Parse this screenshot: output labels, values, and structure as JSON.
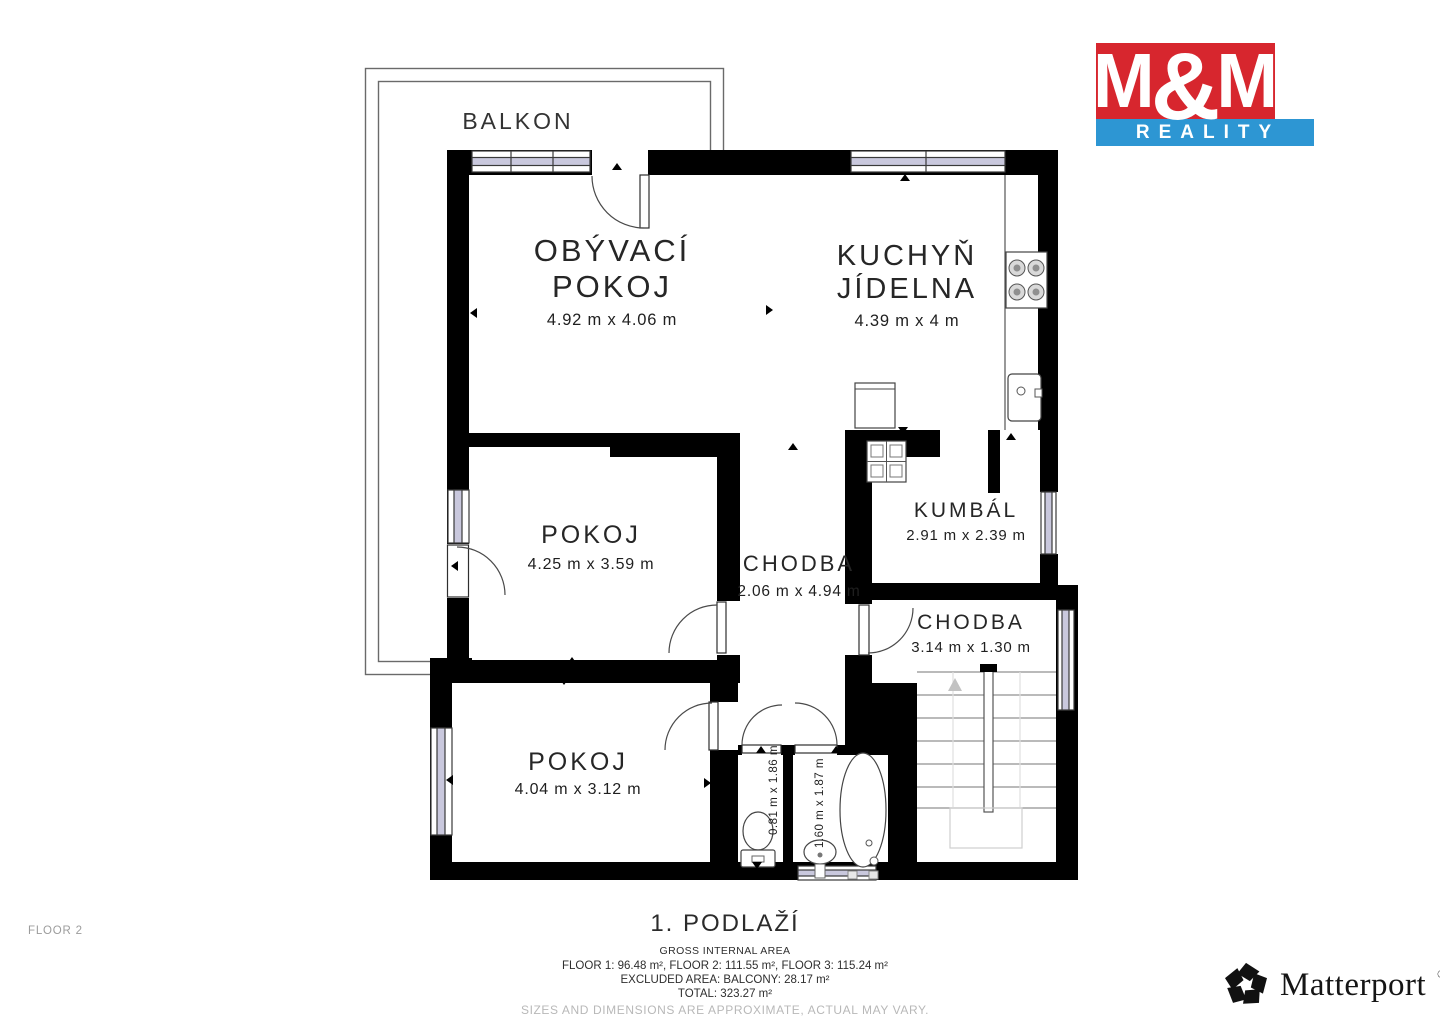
{
  "brand": {
    "m_left": "M",
    "ampersand": "&",
    "m_right": "M",
    "tagline": "REALITY",
    "red": "#d7262e",
    "blue": "#2d96d3"
  },
  "plan": {
    "balkon_label": "BALKON",
    "floor_title": "1. PODLAŽÍ",
    "rooms": {
      "obyvaci": {
        "line1": "OBÝVACÍ",
        "line2": "POKOJ",
        "dims": "4.92 m x 4.06 m"
      },
      "kuchyn": {
        "line1": "KUCHYŇ",
        "line2": "JÍDELNA",
        "dims": "4.39 m x 4 m"
      },
      "pokoj_stred": {
        "line1": "POKOJ",
        "dims": "4.25 m x 3.59 m"
      },
      "chodba_hlavni": {
        "line1": "CHODBA",
        "dims": "2.06 m x 4.94 m"
      },
      "kumbal": {
        "line1": "KUMBÁL",
        "dims": "2.91 m x 2.39 m"
      },
      "chodba_mala": {
        "line1": "CHODBA",
        "dims": "3.14 m x 1.30 m"
      },
      "pokoj_dolni": {
        "line1": "POKOJ",
        "dims": "4.04 m x 3.12 m"
      },
      "wc": {
        "dims": "0.81 m x 1.86 m"
      },
      "koupelna": {
        "dims": "1.60 m x 1.87 m"
      }
    }
  },
  "footer": {
    "gross_area_label": "GROSS INTERNAL AREA",
    "floors_line": "FLOOR 1: 96.48 m², FLOOR 2: 111.55 m², FLOOR 3: 115.24 m²",
    "excluded_line": "EXCLUDED AREA: BALCONY: 28.17 m²",
    "total_line": "TOTAL: 323.27 m²",
    "disclaimer": "SIZES AND DIMENSIONS ARE APPROXIMATE, ACTUAL MAY VARY.",
    "floor_tag": "FLOOR 2"
  },
  "matterport": {
    "name": "Matterport",
    "registered": "®"
  }
}
